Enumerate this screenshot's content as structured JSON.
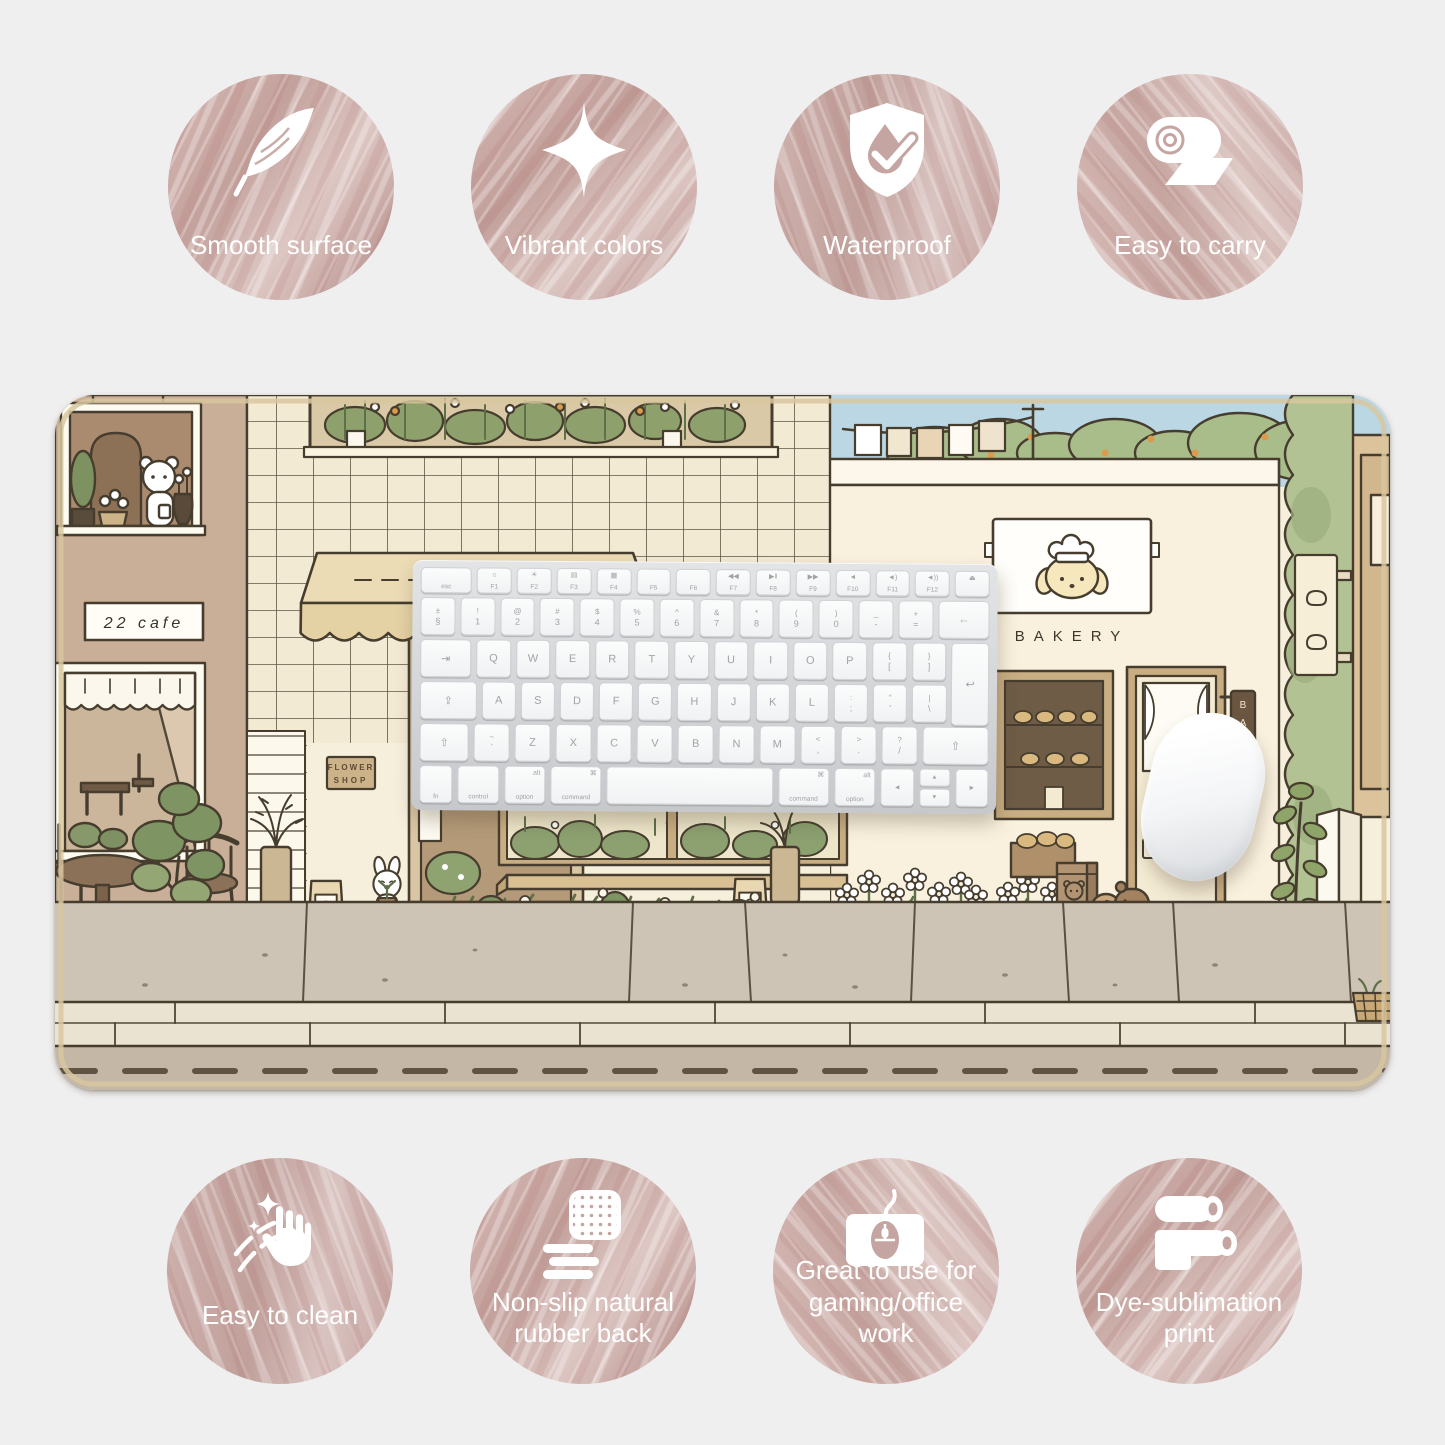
{
  "page": {
    "background": "#f0eff0"
  },
  "badges_top": [
    {
      "icon": "feather-icon",
      "label": "Smooth surface"
    },
    {
      "icon": "sparkle-icon",
      "label": "Vibrant colors"
    },
    {
      "icon": "waterproof-shield-icon",
      "label": "Waterproof"
    },
    {
      "icon": "rolled-mat-icon",
      "label": "Easy to carry"
    }
  ],
  "badges_bottom": [
    {
      "icon": "hand-stars-icon",
      "label": "Easy to clean"
    },
    {
      "icon": "rubber-back-icon",
      "label": "Non-slip natural rubber back"
    },
    {
      "icon": "mouse-pad-icon",
      "label": "Great to use for gaming/office work"
    },
    {
      "icon": "dye-rollers-icon",
      "label": "Dye-sublimation print"
    }
  ],
  "mat": {
    "cafe_sign": "22 cafe",
    "flower_shop_sign_line1": "FLOWER",
    "flower_shop_sign_line2": "SHOP",
    "bakery_wall_text": "BAKERY",
    "open_sign": "OPEN",
    "vertical_sign_letters": [
      "B",
      "A",
      "K",
      "E"
    ],
    "colors": {
      "sky": "#bad7e3",
      "wall_cream": "#f6efdc",
      "wall_tan": "#c9af97",
      "green": "#a9bd8a",
      "awning": "#ecdcb6",
      "pavement": "#cdc4b6",
      "curb": "#eae3d1",
      "road": "#c4b7a6",
      "outline": "#463d2f"
    }
  },
  "keyboard": {
    "rows": [
      [
        {
          "s": "esc",
          "w": 1.5
        },
        {
          "g": "☼",
          "s": "F1"
        },
        {
          "g": "☀",
          "s": "F2"
        },
        {
          "g": "▤",
          "s": "F3"
        },
        {
          "g": "▦",
          "s": "F4"
        },
        {
          "s": "F5"
        },
        {
          "s": "F6"
        },
        {
          "g": "◀◀",
          "s": "F7"
        },
        {
          "g": "▶‖",
          "s": "F8"
        },
        {
          "g": "▶▶",
          "s": "F9"
        },
        {
          "g": "◄",
          "s": "F10"
        },
        {
          "g": "◄)",
          "s": "F11"
        },
        {
          "g": "◄))",
          "s": "F12"
        },
        {
          "g": "⏏"
        }
      ],
      [
        {
          "t": "±",
          "b": "§"
        },
        {
          "t": "!",
          "b": "1"
        },
        {
          "t": "@",
          "b": "2"
        },
        {
          "t": "#",
          "b": "3"
        },
        {
          "t": "$",
          "b": "4"
        },
        {
          "t": "%",
          "b": "5"
        },
        {
          "t": "^",
          "b": "6"
        },
        {
          "t": "&",
          "b": "7"
        },
        {
          "t": "*",
          "b": "8"
        },
        {
          "t": "(",
          "b": "9"
        },
        {
          "t": ")",
          "b": "0"
        },
        {
          "t": "_",
          "b": "-"
        },
        {
          "t": "+",
          "b": "="
        },
        {
          "m": "←",
          "w": 1.5
        }
      ],
      [
        {
          "m": "⇥",
          "w": 1.5
        },
        {
          "m": "Q"
        },
        {
          "m": "W"
        },
        {
          "m": "E"
        },
        {
          "m": "R"
        },
        {
          "m": "T"
        },
        {
          "m": "Y"
        },
        {
          "m": "U"
        },
        {
          "m": "I"
        },
        {
          "m": "O"
        },
        {
          "m": "P"
        },
        {
          "t": "{",
          "b": "["
        },
        {
          "t": "}",
          "b": "]"
        },
        {
          "m": "↩",
          "w": 1.1,
          "cls": "enter"
        }
      ],
      [
        {
          "m": "⇪",
          "w": 1.7
        },
        {
          "m": "A"
        },
        {
          "m": "S"
        },
        {
          "m": "D"
        },
        {
          "m": "F"
        },
        {
          "m": "G"
        },
        {
          "m": "H"
        },
        {
          "m": "J"
        },
        {
          "m": "K"
        },
        {
          "m": "L"
        },
        {
          "t": ":",
          "b": ";"
        },
        {
          "t": "\"",
          "b": "'"
        },
        {
          "t": "|",
          "b": "\\"
        },
        {
          "w": 1.1,
          "cls": "ghost"
        }
      ],
      [
        {
          "m": "⇧",
          "w": 1.4
        },
        {
          "t": "~",
          "b": "`"
        },
        {
          "m": "Z"
        },
        {
          "m": "X"
        },
        {
          "m": "C"
        },
        {
          "m": "V"
        },
        {
          "m": "B"
        },
        {
          "m": "N"
        },
        {
          "m": "M"
        },
        {
          "t": "<",
          "b": ","
        },
        {
          "t": ">",
          "b": "."
        },
        {
          "t": "?",
          "b": "/"
        },
        {
          "m": "⇧",
          "w": 1.9
        }
      ],
      [
        {
          "s": "fn",
          "w": 0.95
        },
        {
          "s": "control",
          "w": 1.2
        },
        {
          "y": "alt",
          "s": "option",
          "w": 1.2
        },
        {
          "y": "⌘",
          "s": "command",
          "w": 1.5
        },
        {
          "m": "",
          "w": 5.0,
          "cls": "space"
        },
        {
          "y": "⌘",
          "s": "command",
          "w": 1.5
        },
        {
          "y": "alt",
          "s": "option",
          "w": 1.2
        },
        {
          "m": "◄",
          "w": 0.95,
          "cls": "arrow"
        },
        {
          "type": "astack",
          "up": "▲",
          "down": "▼",
          "w": 0.95
        },
        {
          "m": "►",
          "w": 0.95,
          "cls": "arrow"
        }
      ]
    ]
  }
}
